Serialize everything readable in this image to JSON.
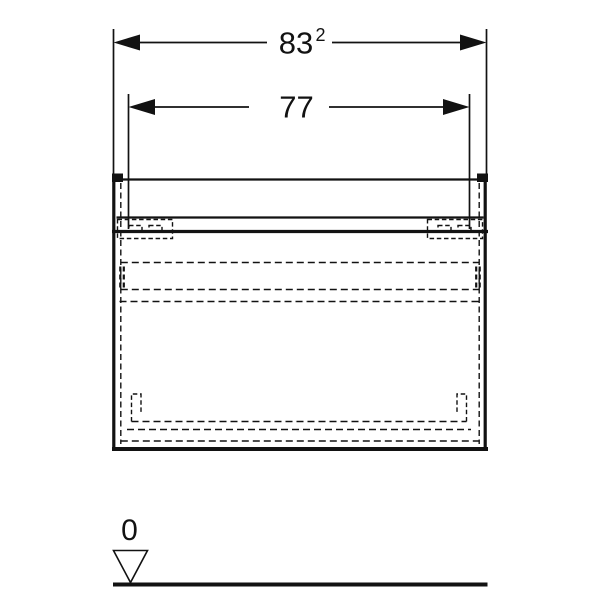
{
  "colors": {
    "line": "#121212",
    "background": "#ffffff"
  },
  "dimensions": {
    "overall_width": {
      "value": "83",
      "superscript": "2"
    },
    "drawer_width": {
      "value": "77"
    }
  },
  "datum": {
    "level_label": "0"
  }
}
